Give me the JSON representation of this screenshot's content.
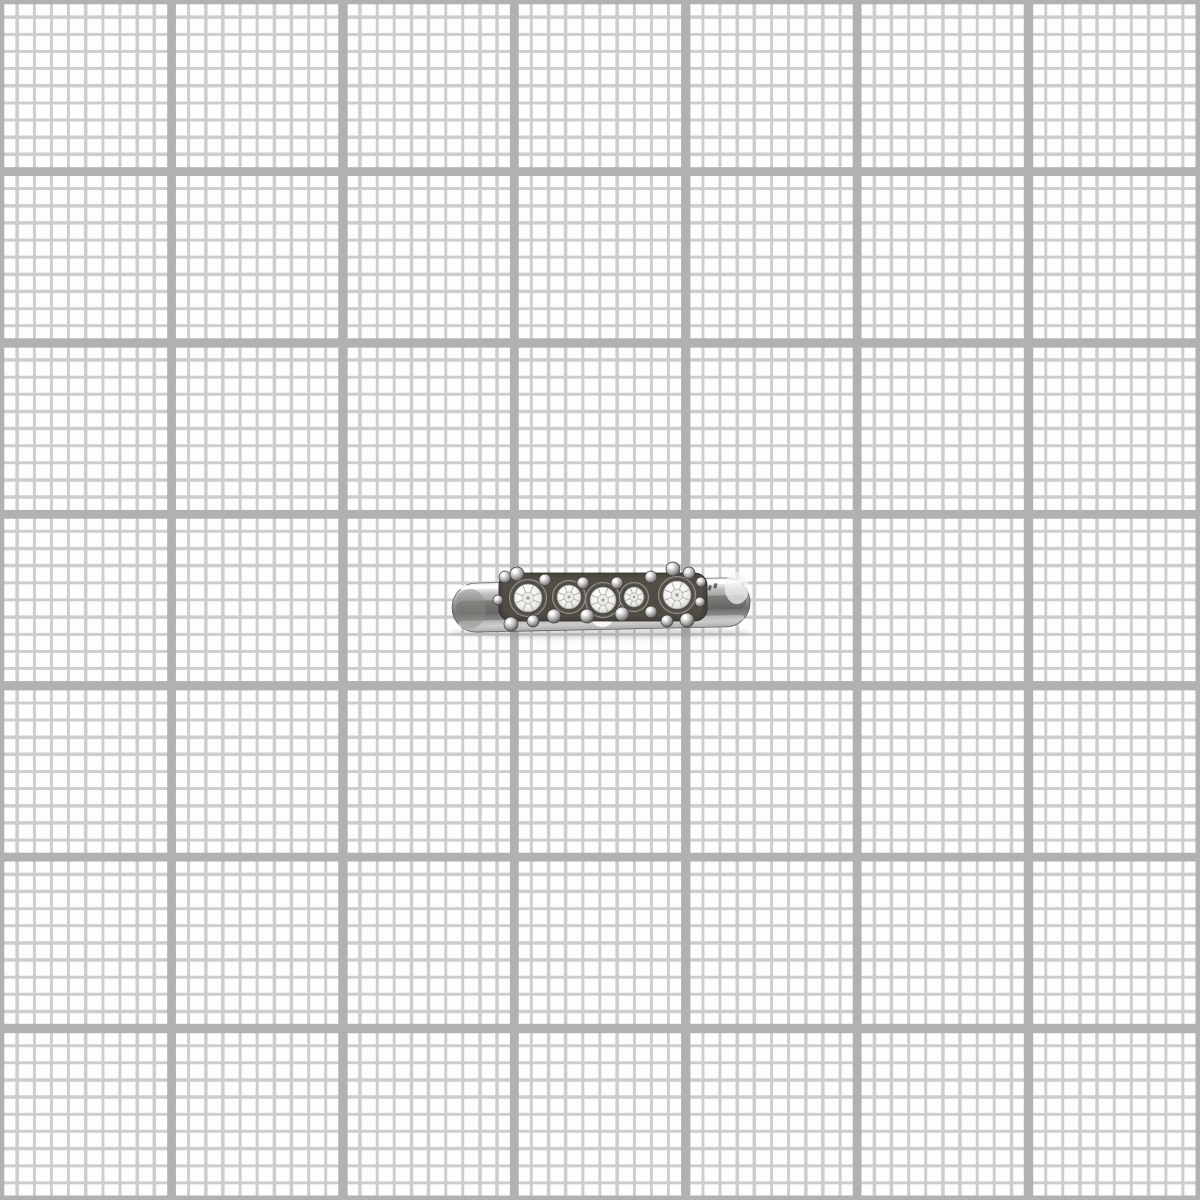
{
  "scene": {
    "type": "photograph",
    "subject": "silver ring with five clear round crystals in a bead-accented channel setting, photographed from the side",
    "background": "white millimeter graph paper"
  },
  "grid": {
    "background_color": "#fdfdfd",
    "minor_cell_px": "17.143px",
    "minor_line_px": "3.2px",
    "minor_color": "#cdcdcd",
    "major_cell_px": "171.43px",
    "major_line_px": "9px",
    "major_color": "#b1b1b1"
  },
  "ring": {
    "viewBox": "444 550 316 100",
    "shadow": {
      "cx": 600,
      "cy": 633,
      "rx": 150,
      "ry": 5.5,
      "fill": "#6a6a6a",
      "opacity": 0.22
    },
    "band": {
      "tilt_deg": -1.2,
      "pivot_x": 600,
      "pivot_y": 602,
      "x": 452,
      "y": 580.5,
      "w": 298,
      "h": 49,
      "rx": 24.5,
      "stroke": "#63625f",
      "gradient": [
        [
          "0",
          "#ededed"
        ],
        [
          "0.08",
          "#fafafa"
        ],
        [
          "0.22",
          "#c2c2c2"
        ],
        [
          "0.45",
          "#909090"
        ],
        [
          "0.62",
          "#6f6f6f"
        ],
        [
          "0.78",
          "#8c8c8c"
        ],
        [
          "0.9",
          "#c9c9c9"
        ],
        [
          "1",
          "#a9a9a9"
        ]
      ],
      "streaks": [
        {
          "shape": "rect",
          "x": 456,
          "y": 598,
          "w": 290,
          "h": 14,
          "rx": 7,
          "fill": "#5b5b58",
          "opacity": 0.5
        },
        {
          "shape": "rect",
          "x": 458,
          "y": 618,
          "w": 286,
          "h": 6,
          "rx": 3,
          "fill": "#d9d9d6",
          "opacity": 0.55
        },
        {
          "shape": "rect",
          "x": 460,
          "y": 582.5,
          "w": 282,
          "h": 4,
          "rx": 2,
          "fill": "#ffffff",
          "opacity": 0.85
        },
        {
          "shape": "ellipse",
          "cx": 470,
          "cy": 606,
          "rx": 16,
          "ry": 20,
          "fill": "#8a8a86",
          "opacity": 0.45
        },
        {
          "shape": "ellipse",
          "cx": 737,
          "cy": 591,
          "rx": 12,
          "ry": 16,
          "fill": "#f5f5f3",
          "opacity": 0.7
        },
        {
          "shape": "ellipse",
          "cx": 602,
          "cy": 620,
          "rx": 10,
          "ry": 7,
          "fill": "#ffffff",
          "opacity": 0.85
        }
      ]
    },
    "setting_bar": {
      "x": 499,
      "y": 573,
      "w": 208,
      "h": 48,
      "rx": 12,
      "fill": "#46413a",
      "stroke": "#23201c",
      "inner": {
        "x": 503,
        "y": 577,
        "w": 200,
        "h": 40,
        "rx": 10,
        "fill": "#57514a",
        "opacity": 0.6
      }
    },
    "stone_style": {
      "bezel_extra_r": 4.5,
      "bezel_stroke": "#9a968f",
      "bezel_gradient": [
        [
          "0",
          "#3a3732"
        ],
        [
          "0.7",
          "#4e4a44"
        ],
        [
          "0.9",
          "#6e6a63"
        ],
        [
          "1",
          "#8f8b84"
        ]
      ],
      "crystal_gradient": [
        [
          "0",
          "#ffffff"
        ],
        [
          "0.45",
          "#f7f7f5"
        ],
        [
          "0.7",
          "#e3e3e0"
        ],
        [
          "0.88",
          "#c2c2bf"
        ],
        [
          "1",
          "#9b9b98"
        ]
      ],
      "crystal_stroke": "#8c8c89",
      "facet_stroke": "#a9a9a6",
      "table_fill": "#eceae6",
      "table_stroke": "#b5b3ae",
      "center_dot_fill": "#8a8880"
    },
    "stones": [
      {
        "cx": 528,
        "cy": 598,
        "r": 14
      },
      {
        "cx": 569,
        "cy": 597,
        "r": 12
      },
      {
        "cx": 603,
        "cy": 600,
        "r": 13
      },
      {
        "cx": 634,
        "cy": 597,
        "r": 10
      },
      {
        "cx": 677,
        "cy": 595,
        "r": 14
      }
    ],
    "bead_style": {
      "gradient": [
        [
          "0",
          "#ffffff"
        ],
        [
          "0.25",
          "#e8e8e8"
        ],
        [
          "0.55",
          "#b0b0b0"
        ],
        [
          "0.8",
          "#787878"
        ],
        [
          "1",
          "#565656"
        ]
      ],
      "stroke": "#3f3b36"
    },
    "beads": [
      {
        "cx": 505,
        "cy": 577,
        "r": 6
      },
      {
        "cx": 517,
        "cy": 574,
        "r": 7
      },
      {
        "cx": 545,
        "cy": 580,
        "r": 6
      },
      {
        "cx": 583,
        "cy": 583,
        "r": 6
      },
      {
        "cx": 617,
        "cy": 583,
        "r": 6
      },
      {
        "cx": 651,
        "cy": 577,
        "r": 6
      },
      {
        "cx": 673,
        "cy": 569,
        "r": 7
      },
      {
        "cx": 689,
        "cy": 573,
        "r": 6
      },
      {
        "cx": 701,
        "cy": 582,
        "r": 5
      },
      {
        "cx": 498,
        "cy": 600,
        "r": 5
      },
      {
        "cx": 511,
        "cy": 624,
        "r": 7
      },
      {
        "cx": 533,
        "cy": 621,
        "r": 6
      },
      {
        "cx": 554,
        "cy": 616,
        "r": 7
      },
      {
        "cx": 587,
        "cy": 616,
        "r": 7
      },
      {
        "cx": 622,
        "cy": 614,
        "r": 7
      },
      {
        "cx": 651,
        "cy": 612,
        "r": 6
      },
      {
        "cx": 667,
        "cy": 621,
        "r": 6
      },
      {
        "cx": 687,
        "cy": 620,
        "r": 7
      },
      {
        "cx": 700,
        "cy": 602,
        "r": 5
      }
    ],
    "hallmarks": [
      {
        "x": 709,
        "y": 585,
        "w": 3,
        "h": 5,
        "rot": 15,
        "fill": "#4a4a4a",
        "opacity": 0.85
      },
      {
        "x": 714.5,
        "y": 583,
        "w": 3,
        "h": 5,
        "rot": 15,
        "fill": "#4a4a4a",
        "opacity": 0.85
      }
    ]
  }
}
